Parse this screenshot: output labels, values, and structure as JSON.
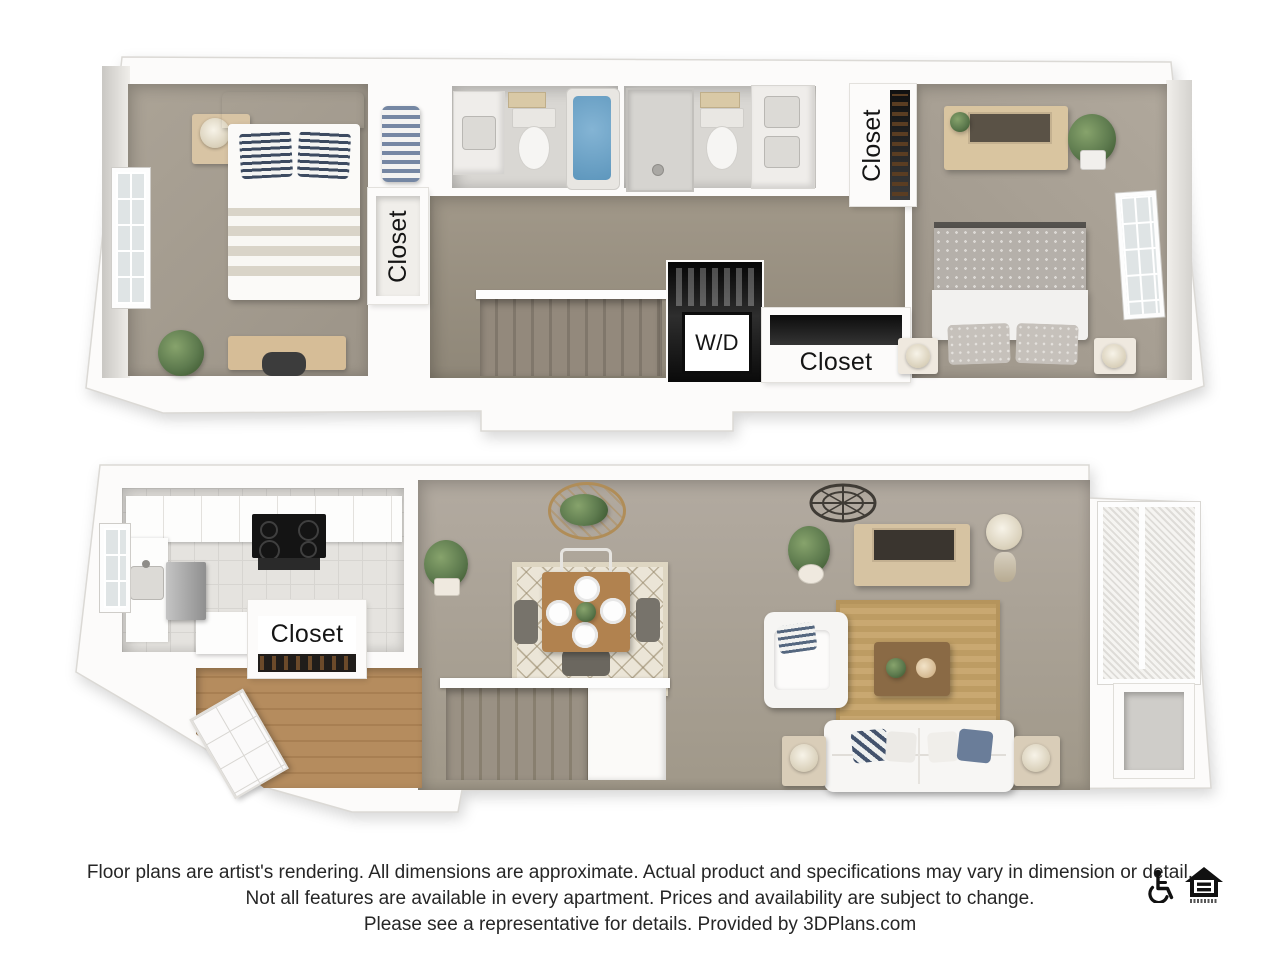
{
  "upper_floor": {
    "labels": {
      "closet_bedroom": "Closet",
      "closet_master": "Closet",
      "closet_hall": "Closet",
      "washer_dryer": "W/D"
    }
  },
  "lower_floor": {
    "labels": {
      "closet_entry": "Closet"
    }
  },
  "disclaimer": {
    "line1": "Floor plans are artist's rendering. All dimensions are approximate. Actual product and specifications may vary in dimension or detail.",
    "line2": "Not all features are available in every apartment. Prices and availability are subject to change.",
    "line3": "Please see a representative for details. Provided by 3DPlans.com"
  },
  "icons": [
    "accessibility-wheelchair-icon",
    "equal-housing-opportunity-icon"
  ],
  "colors": {
    "background": "#ffffff",
    "wall": "#fcfbfa",
    "carpet_upper": "#a29a8e",
    "carpet_hall": "#98907f",
    "carpet_lower": "#a8a096",
    "bath_floor": "#d9d7d3",
    "kitchen_tile": "#e5e3df",
    "entry_wood": "#b58c5e",
    "stair_tread": "#8f8679",
    "tub_water": "#6aa3c8",
    "jute_rug": "#c6a56e",
    "dining_rug": "#ebe5d7",
    "wood_furniture": "#d7c3a0",
    "dining_table": "#b1824f",
    "label_text": "#151515",
    "disclaimer_text": "#262626"
  }
}
